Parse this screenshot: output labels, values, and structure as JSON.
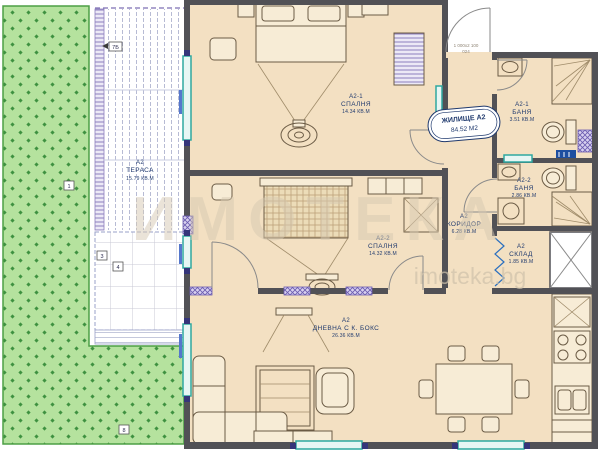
{
  "plan": {
    "unit_badge": {
      "title": "ЖИЛИЩЕ А2",
      "area": "84.52 М2"
    },
    "door_spec": {
      "line1": "1 000х2 100",
      "line2": "024"
    },
    "watermark": {
      "brand": "ИМОТЕКА",
      "site": "imoteka.bg"
    },
    "rooms": {
      "terrace": {
        "id": "А2",
        "name": "ТЕРАСА",
        "area": "15.79 КВ.М"
      },
      "bedroom1": {
        "id": "А2-1",
        "name": "СПАЛНЯ",
        "area": "14.34 КВ.М"
      },
      "bedroom2": {
        "id": "А2-2",
        "name": "СПАЛНЯ",
        "area": "14.32 КВ.М"
      },
      "living": {
        "id": "А2",
        "name": "ДНЕВНА С К. БОКС",
        "area": "26.36 КВ.М"
      },
      "corridor": {
        "id": "А2",
        "name": "КОРИДОР",
        "area": "6.28 КВ.М"
      },
      "bath1": {
        "id": "А2-1",
        "name": "БАНЯ",
        "area": "3.51 КВ.М"
      },
      "bath2": {
        "id": "А2-2",
        "name": "БАНЯ",
        "area": "2.86 КВ.М"
      },
      "storage": {
        "id": "А2",
        "name": "СКЛАД",
        "area": "1.85 КВ.М"
      }
    },
    "markers": {
      "m1": "1",
      "m7b": "7Б",
      "m3": "3",
      "m4": "4",
      "m8": "8"
    },
    "colors": {
      "grass": "#b5e29e",
      "grass_dot": "#3e9140",
      "floor": "#f3e0c2",
      "wall": "#515156",
      "window_teal": "#2fa8a0",
      "label_navy": "#203a6e",
      "shaft_purple": "#6a5bb0",
      "watermark": "#d6c9b2"
    }
  }
}
